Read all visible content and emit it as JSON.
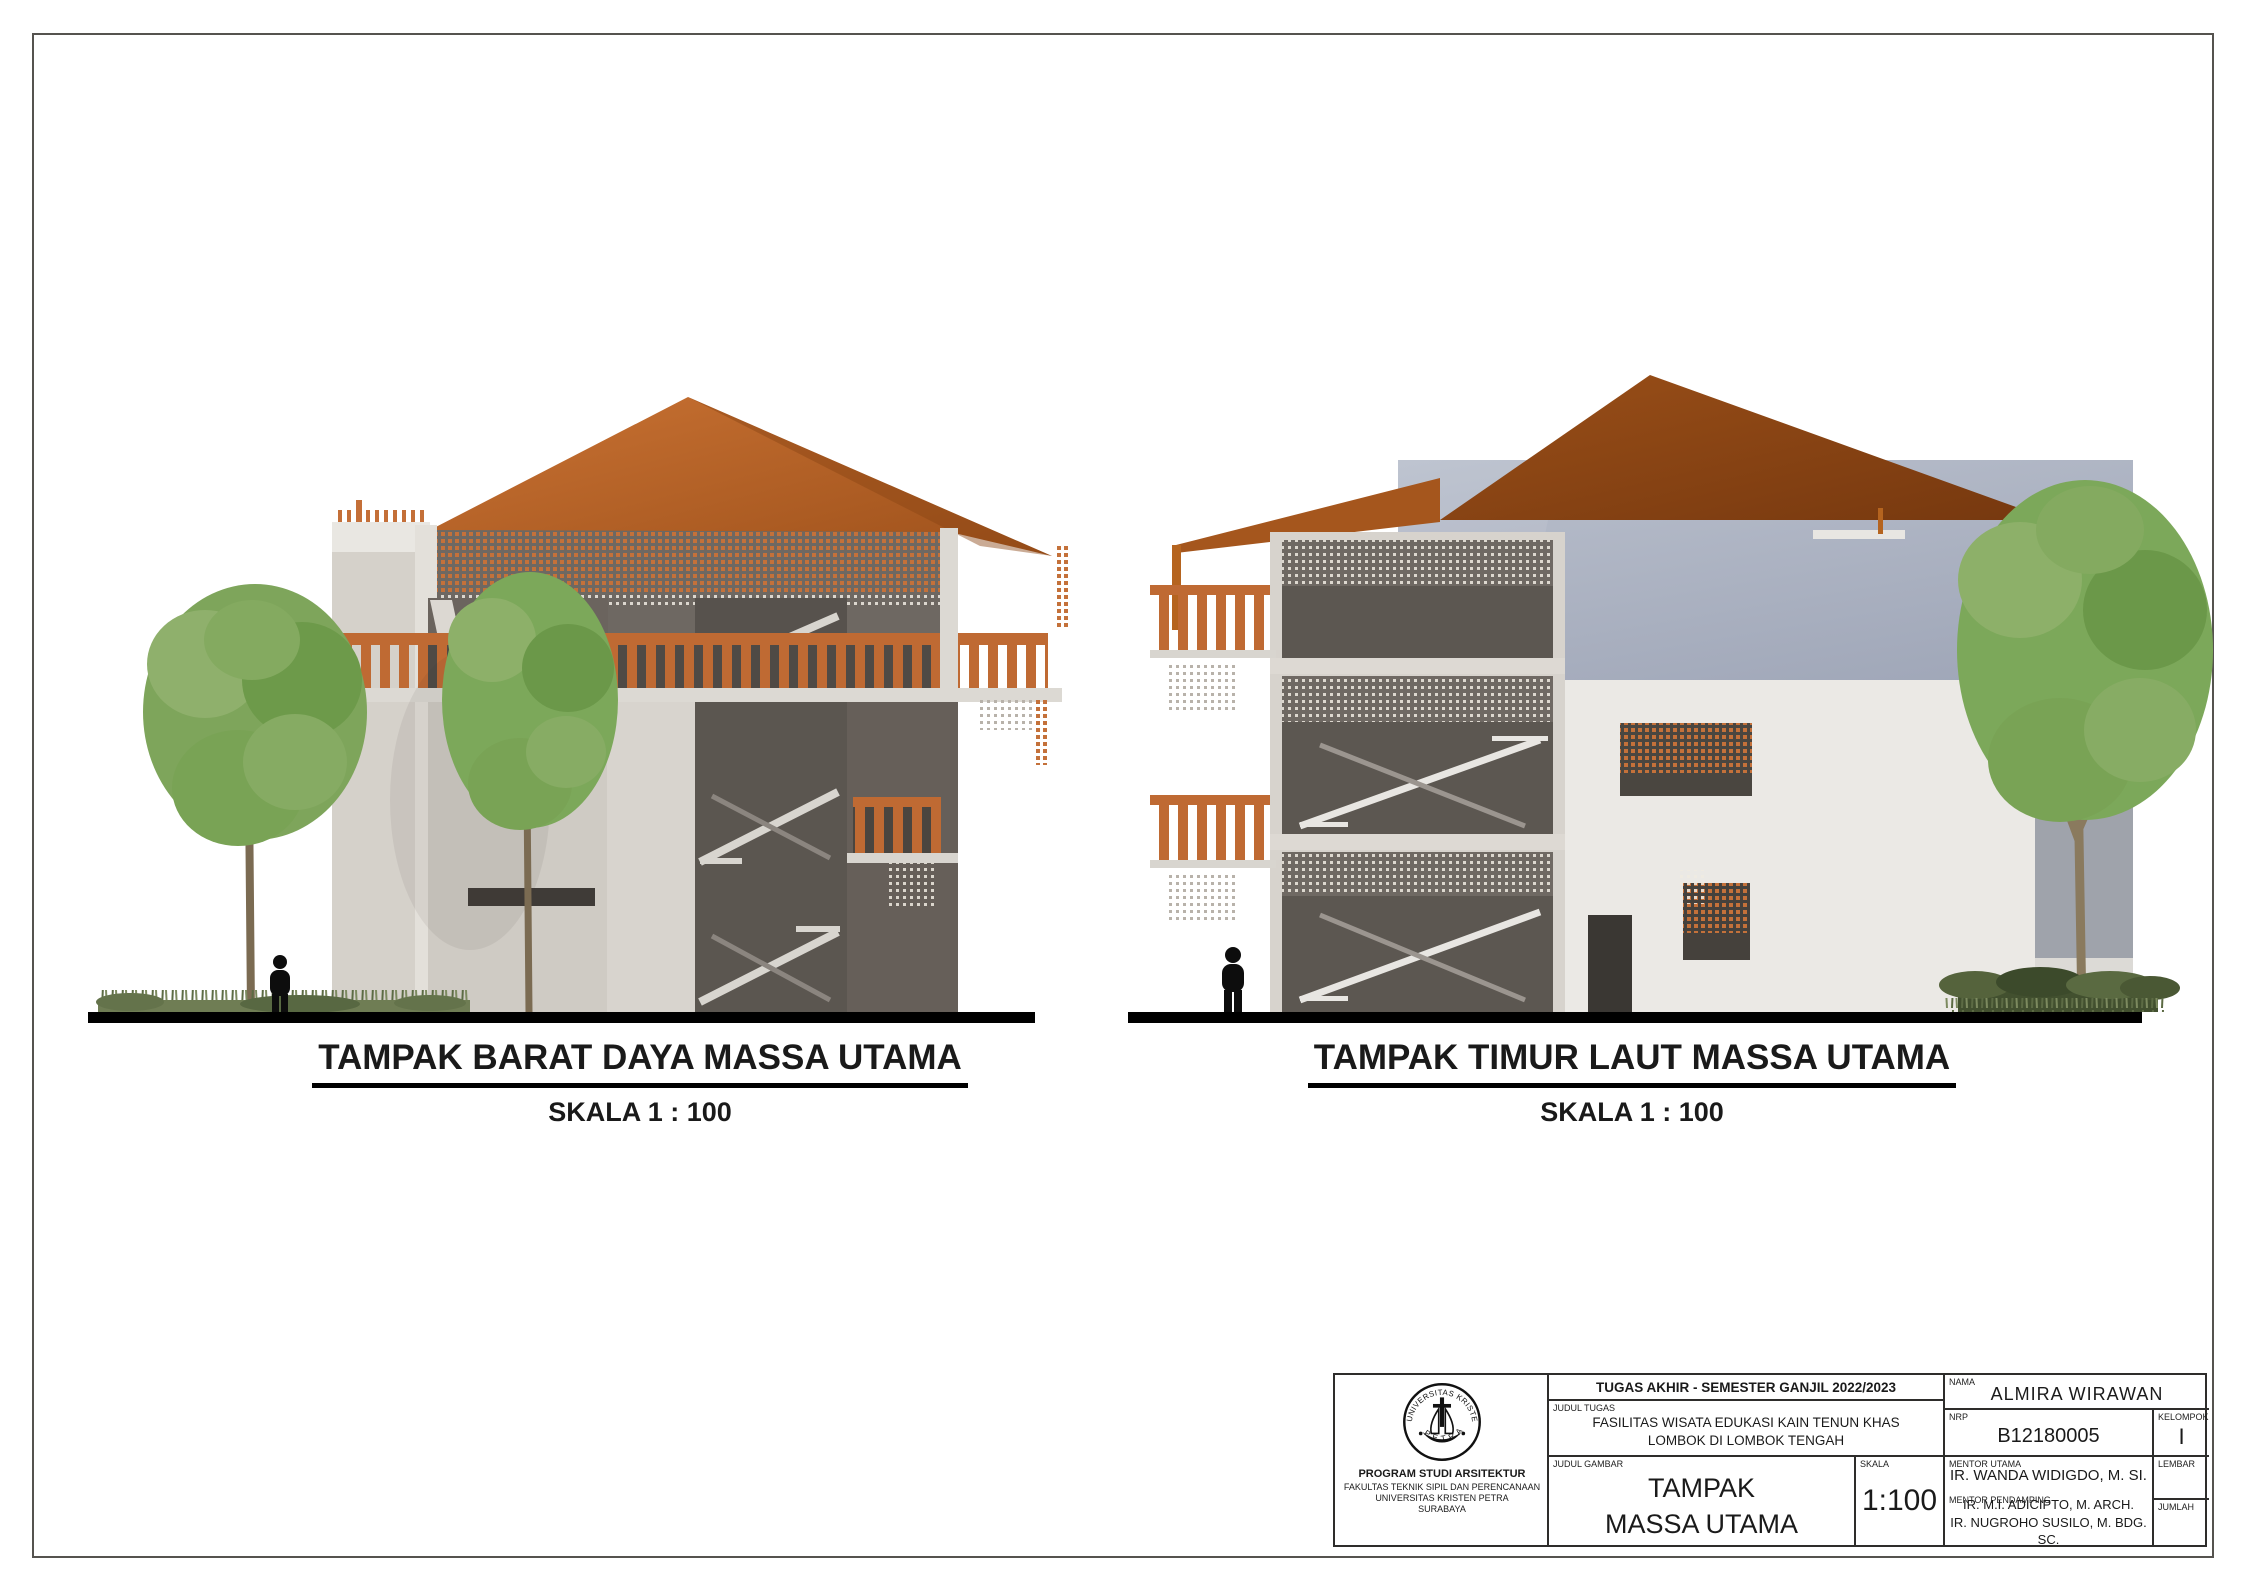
{
  "figures": {
    "left": {
      "title": "TAMPAK BARAT DAYA MASSA UTAMA",
      "scale": "SKALA 1 : 100"
    },
    "right": {
      "title": "TAMPAK TIMUR LAUT MASSA UTAMA",
      "scale": "SKALA 1 : 100"
    }
  },
  "title_block": {
    "header": "TUGAS AKHIR - SEMESTER GANJIL 2022/2023",
    "judul_tugas_label": "JUDUL TUGAS",
    "judul_tugas_line1": "FASILITAS WISATA EDUKASI KAIN TENUN KHAS",
    "judul_tugas_line2": "LOMBOK DI LOMBOK TENGAH",
    "judul_gambar_label": "JUDUL GAMBAR",
    "judul_gambar_line1": "TAMPAK",
    "judul_gambar_line2": "MASSA UTAMA",
    "skala_label": "SKALA",
    "skala_value": "1:100",
    "nama_label": "NAMA",
    "nama_value": "ALMIRA WIRAWAN",
    "nrp_label": "NRP",
    "nrp_value": "B12180005",
    "kelompok_label": "KELOMPOK",
    "kelompok_value": "I",
    "mentor_utama_label": "MENTOR UTAMA",
    "mentor_utama_value": "IR. WANDA WIDIGDO,  M. SI.",
    "mentor_pendamping_label": "MENTOR PENDAMPING",
    "mentor_pendamping_line1": "IR. M.I. ADICIPTO, M. ARCH.",
    "mentor_pendamping_line2": "IR. NUGROHO SUSILO, M. BDG. SC.",
    "lembar_label": "LEMBAR",
    "jumlah_label": "JUMLAH",
    "institution": {
      "logo_arc_top": "UNIVERSITAS KRISTEN",
      "logo_arc_bottom": "PETRA",
      "line1": "PROGRAM STUDI ARSITEKTUR",
      "line2": "FAKULTAS TEKNIK SIPIL DAN PERENCANAAN",
      "line3": "UNIVERSITAS KRISTEN PETRA",
      "line4": "SURABAYA"
    }
  },
  "colors": {
    "roof_orange": "#bc6526",
    "roof_dark": "#8e4715",
    "lattice_orange": "#c4713a",
    "balustrade_orange": "#bf6a33",
    "concrete_light": "#d5d1ca",
    "concrete_bright": "#e9e7e2",
    "wall_dark": "#6e6862",
    "bay_dark": "#57524d",
    "glass_top": "#b9bfcc",
    "glass_bottom": "#969eb0",
    "tree_green": "#7ca85a",
    "ground": "#000000"
  }
}
